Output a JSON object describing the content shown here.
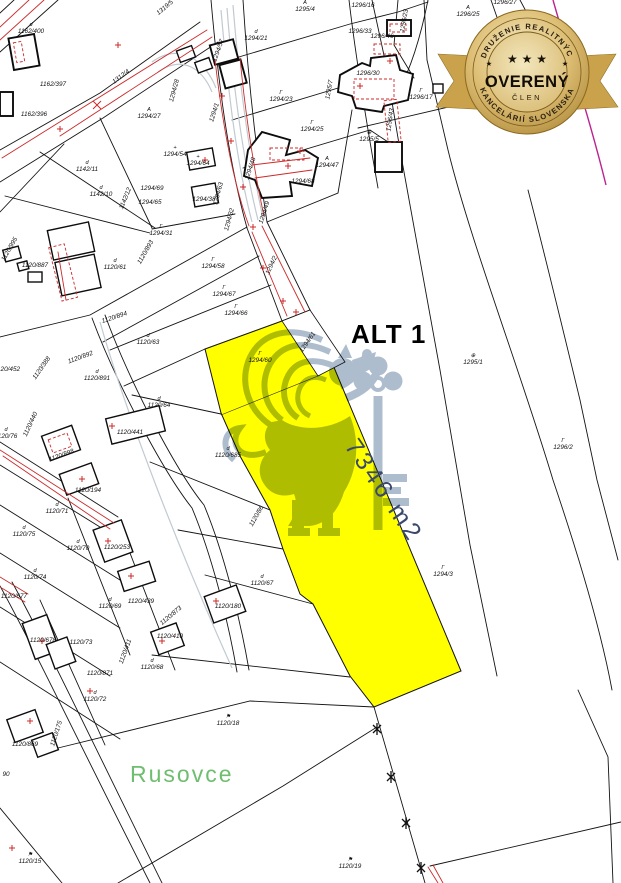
{
  "map": {
    "alt_label": "ALT 1",
    "highlight_area_label": "7346 m2",
    "place_label": "Rusovce",
    "colors": {
      "highlight": "#ffff00",
      "boundary": "#141414",
      "annotation_red": "#cc2a2a",
      "utility_gray": "#c0cad0",
      "place_green": "#6fbe6f",
      "watermark_blue": "#9aacc2",
      "area_text": "#3a486b",
      "badge_gold": "#c9a452",
      "boundary_magenta": "#bb2390"
    },
    "parcel_labels": [
      {
        "t": "1162/400",
        "x": 31,
        "y": 33,
        "s": "d"
      },
      {
        "t": "1162/397",
        "x": 53,
        "y": 86
      },
      {
        "t": "1162/396",
        "x": 34,
        "y": 116
      },
      {
        "t": "1312/4",
        "x": 122,
        "y": 78,
        "r": -37
      },
      {
        "t": "1319/5",
        "x": 166,
        "y": 9,
        "r": -40
      },
      {
        "t": "1294/27",
        "x": 149,
        "y": 118,
        "s": "A"
      },
      {
        "t": "1294/28",
        "x": 176,
        "y": 91,
        "r": -75
      },
      {
        "t": "1294/54",
        "x": 175,
        "y": 156,
        "s": "+"
      },
      {
        "t": "1294/1",
        "x": 216,
        "y": 113,
        "r": -72
      },
      {
        "t": "1294/57",
        "x": 220,
        "y": 51,
        "r": -70
      },
      {
        "t": "1294/21",
        "x": 256,
        "y": 40,
        "s": "d"
      },
      {
        "t": "1295/4",
        "x": 305,
        "y": 11,
        "s": "A"
      },
      {
        "t": "1294/23",
        "x": 281,
        "y": 101,
        "s": "Γ"
      },
      {
        "t": "1294/25",
        "x": 312,
        "y": 131,
        "s": "Γ"
      },
      {
        "t": "1295/7",
        "x": 331,
        "y": 90,
        "r": -80
      },
      {
        "t": "1296/16",
        "x": 363,
        "y": 7
      },
      {
        "t": "1296/23",
        "x": 406,
        "y": 21,
        "r": -80
      },
      {
        "t": "1296/25",
        "x": 468,
        "y": 16,
        "s": "A"
      },
      {
        "t": "1296/27",
        "x": 505,
        "y": 4
      },
      {
        "t": "1296/33",
        "x": 360,
        "y": 33
      },
      {
        "t": "1296/46",
        "x": 382,
        "y": 38
      },
      {
        "t": "1296/30",
        "x": 368,
        "y": 75
      },
      {
        "t": "1296/43",
        "x": 392,
        "y": 120,
        "r": -82,
        "c": "#cc2a2a"
      },
      {
        "t": "1296/17",
        "x": 421,
        "y": 99,
        "s": "Γ"
      },
      {
        "t": "1295/5",
        "x": 369,
        "y": 141,
        "s": "⊕"
      },
      {
        "t": "1294/47",
        "x": 327,
        "y": 167,
        "s": "A"
      },
      {
        "t": "1294/68",
        "x": 303,
        "y": 183
      },
      {
        "t": "1294/48",
        "x": 252,
        "y": 169,
        "r": -72
      },
      {
        "t": "1294/49",
        "x": 266,
        "y": 213,
        "r": -72
      },
      {
        "t": "1294/64",
        "x": 198,
        "y": 165,
        "s": "+"
      },
      {
        "t": "1294/38",
        "x": 204,
        "y": 201
      },
      {
        "t": "1294/63",
        "x": 220,
        "y": 194,
        "r": -75
      },
      {
        "t": "1294/32",
        "x": 231,
        "y": 220,
        "r": -75
      },
      {
        "t": "1294/69",
        "x": 152,
        "y": 190
      },
      {
        "t": "1294/65",
        "x": 150,
        "y": 204
      },
      {
        "t": "1142/11",
        "x": 87,
        "y": 171,
        "s": "d"
      },
      {
        "t": "1142/10",
        "x": 101,
        "y": 196,
        "s": "d"
      },
      {
        "t": "1142/12",
        "x": 127,
        "y": 199,
        "r": -68
      },
      {
        "t": "1294/31",
        "x": 161,
        "y": 235,
        "s": "Γ"
      },
      {
        "t": "1120/887",
        "x": 35,
        "y": 267
      },
      {
        "t": "1120/61",
        "x": 115,
        "y": 269,
        "s": "d"
      },
      {
        "t": "1120/995",
        "x": 11,
        "y": 250,
        "r": -60
      },
      {
        "t": "1120/893",
        "x": 147,
        "y": 253,
        "r": -60
      },
      {
        "t": "1294/58",
        "x": 213,
        "y": 268,
        "s": "Γ"
      },
      {
        "t": "1294/67",
        "x": 224,
        "y": 296,
        "s": "Γ"
      },
      {
        "t": "1294/66",
        "x": 236,
        "y": 315,
        "s": "Γ"
      },
      {
        "t": "1294/2",
        "x": 273,
        "y": 266,
        "r": -65
      },
      {
        "t": "1120/894",
        "x": 115,
        "y": 319,
        "r": -18
      },
      {
        "t": "1120/63",
        "x": 148,
        "y": 344,
        "s": "d"
      },
      {
        "t": "1120/892",
        "x": 81,
        "y": 359,
        "r": -20
      },
      {
        "t": "1120/891",
        "x": 97,
        "y": 380,
        "s": "d"
      },
      {
        "t": "1120/452",
        "x": 7,
        "y": 371
      },
      {
        "t": "1120/388",
        "x": 43,
        "y": 369,
        "r": -55
      },
      {
        "t": "1294/60",
        "x": 260,
        "y": 362,
        "s": "Γ"
      },
      {
        "t": "1294/61",
        "x": 309,
        "y": 343,
        "r": -55
      },
      {
        "t": "1295/1",
        "x": 473,
        "y": 364,
        "s": "⊕"
      },
      {
        "t": "1120/64",
        "x": 159,
        "y": 407,
        "s": "d"
      },
      {
        "t": "1120/440",
        "x": 32,
        "y": 425,
        "r": -65
      },
      {
        "t": "1120/76",
        "x": 6,
        "y": 438,
        "s": "d"
      },
      {
        "t": "1120/441",
        "x": 130,
        "y": 434
      },
      {
        "t": "1120/685",
        "x": 228,
        "y": 457,
        "s": "d"
      },
      {
        "t": "1296/2",
        "x": 563,
        "y": 449,
        "s": "Γ"
      },
      {
        "t": "1120/898",
        "x": 62,
        "y": 457,
        "r": -20
      },
      {
        "t": "1120/194",
        "x": 88,
        "y": 492
      },
      {
        "t": "1120/86",
        "x": 258,
        "y": 517,
        "r": -60
      },
      {
        "t": "1120/71",
        "x": 57,
        "y": 513,
        "s": "d"
      },
      {
        "t": "1120/75",
        "x": 24,
        "y": 536,
        "s": "d"
      },
      {
        "t": "1120/70",
        "x": 78,
        "y": 550,
        "s": "d"
      },
      {
        "t": "1120/253",
        "x": 117,
        "y": 549
      },
      {
        "t": "1120/74",
        "x": 35,
        "y": 579,
        "s": "d"
      },
      {
        "t": "1294/3",
        "x": 443,
        "y": 576,
        "s": "Γ"
      },
      {
        "t": "1120/67",
        "x": 262,
        "y": 585,
        "s": "d"
      },
      {
        "t": "1120/677",
        "x": 14,
        "y": 598
      },
      {
        "t": "1120/69",
        "x": 110,
        "y": 608,
        "s": "d"
      },
      {
        "t": "1120/439",
        "x": 141,
        "y": 603
      },
      {
        "t": "1120/180",
        "x": 228,
        "y": 608
      },
      {
        "t": "1120/873",
        "x": 172,
        "y": 617,
        "r": -40
      },
      {
        "t": "1120/678",
        "x": 43,
        "y": 642
      },
      {
        "t": "1120/73",
        "x": 81,
        "y": 644
      },
      {
        "t": "1120/410",
        "x": 170,
        "y": 638
      },
      {
        "t": "1120/411",
        "x": 127,
        "y": 652,
        "r": -70
      },
      {
        "t": "1120/68",
        "x": 152,
        "y": 669,
        "s": "d"
      },
      {
        "t": "1120/871",
        "x": 100,
        "y": 675
      },
      {
        "t": "1120/72",
        "x": 95,
        "y": 701,
        "s": "d"
      },
      {
        "t": "1120/18",
        "x": 228,
        "y": 725,
        "s": "⚑"
      },
      {
        "t": "1120/869",
        "x": 25,
        "y": 746
      },
      {
        "t": "1120/175",
        "x": 58,
        "y": 734,
        "r": -72
      },
      {
        "t": "90",
        "x": 6,
        "y": 776
      },
      {
        "t": "1120/15",
        "x": 30,
        "y": 863,
        "s": "⚑"
      },
      {
        "t": "1120/19",
        "x": 350,
        "y": 868,
        "s": "⚑"
      }
    ]
  },
  "badge": {
    "top_arc": "ZDRUŽENIE REALITNÝCH",
    "bottom_arc": "KANCELÁRIÍ SLOVENSKA",
    "title": "OVERENÝ",
    "subtitle": "ČLEN",
    "stars": "★ ★ ★",
    "star_small": "★"
  }
}
